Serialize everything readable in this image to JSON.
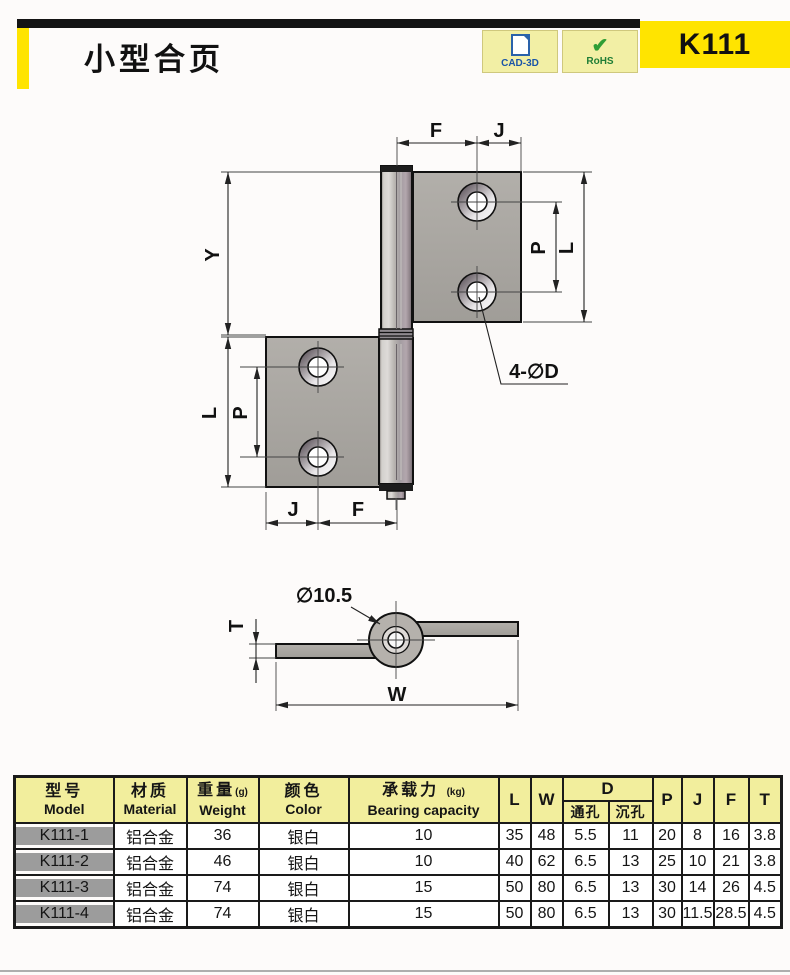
{
  "page": {
    "background": "#fdfbfa",
    "bottom_rule_color": "#aeaeae"
  },
  "header": {
    "title": "小型合页",
    "product_code": "K111",
    "accent_yellow": "#ffe400",
    "bar_color": "#141414",
    "badges": [
      {
        "label": "CAD-3D",
        "color": "#1a55a8",
        "bg": "#f2efa5"
      },
      {
        "label": "RoHS",
        "check": "✔",
        "color": "#1f7d36",
        "bg": "#f2efa5"
      }
    ]
  },
  "drawing": {
    "flag_view": {
      "dim_F_top": "F",
      "dim_J_top": "J",
      "dim_Y": "Y",
      "dim_P_right": "P",
      "dim_L_right": "L",
      "hole_callout": "4-∅D",
      "dim_L_left": "L",
      "dim_P_left": "P",
      "dim_J_bottom": "J",
      "dim_F_bottom": "F"
    },
    "side_view": {
      "knuckle_diameter": "∅10.5",
      "dim_T": "T",
      "dim_W": "W"
    },
    "metal_color": "#a9a6a1"
  },
  "table": {
    "header_bg": "#f2ee9d",
    "model_col_bg": "#9c9c9c",
    "headers": {
      "model": {
        "zh": "型号",
        "en": "Model"
      },
      "material": {
        "zh": "材质",
        "en": "Material"
      },
      "weight": {
        "zh": "重量",
        "unit": "(g)",
        "en": "Weight"
      },
      "color": {
        "zh": "颜色",
        "en": "Color"
      },
      "bearing": {
        "zh": "承载力",
        "unit": "(kg)",
        "en": "Bearing capacity"
      },
      "l": "L",
      "w": "W",
      "d": "D",
      "d_through": "通孔",
      "d_sink": "沉孔",
      "p": "P",
      "j": "J",
      "f": "F",
      "t": "T"
    },
    "rows": [
      {
        "model": "K111-1",
        "material": "铝合金",
        "weight": "36",
        "color": "银白",
        "bearing": "10",
        "l": "35",
        "w": "48",
        "d_through": "5.5",
        "d_sink": "11",
        "p": "20",
        "j": "8",
        "f": "16",
        "t": "3.8"
      },
      {
        "model": "K111-2",
        "material": "铝合金",
        "weight": "46",
        "color": "银白",
        "bearing": "10",
        "l": "40",
        "w": "62",
        "d_through": "6.5",
        "d_sink": "13",
        "p": "25",
        "j": "10",
        "f": "21",
        "t": "3.8"
      },
      {
        "model": "K111-3",
        "material": "铝合金",
        "weight": "74",
        "color": "银白",
        "bearing": "15",
        "l": "50",
        "w": "80",
        "d_through": "6.5",
        "d_sink": "13",
        "p": "30",
        "j": "14",
        "f": "26",
        "t": "4.5"
      },
      {
        "model": "K111-4",
        "material": "铝合金",
        "weight": "74",
        "color": "银白",
        "bearing": "15",
        "l": "50",
        "w": "80",
        "d_through": "6.5",
        "d_sink": "13",
        "p": "30",
        "j": "11.5",
        "f": "28.5",
        "t": "4.5"
      }
    ]
  }
}
